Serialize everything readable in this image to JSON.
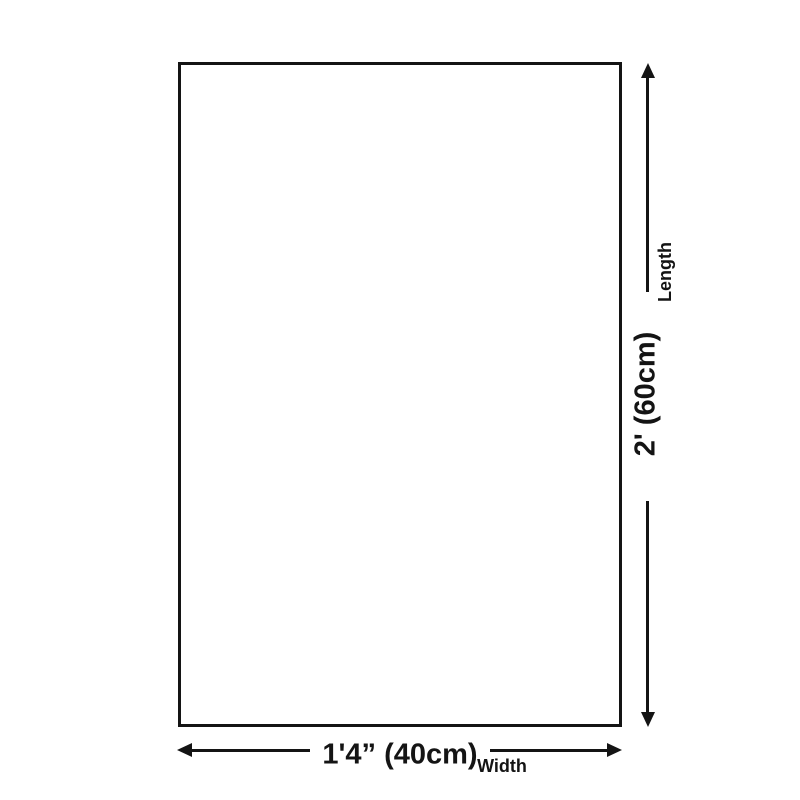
{
  "page": {
    "background_color": "#ffffff",
    "ink_color": "#141414"
  },
  "diagram": {
    "shape": "rectangle",
    "vertical_dimension": {
      "value": "2' (60cm)",
      "label": "Length"
    },
    "horizontal_dimension": {
      "value": "1'4” (40cm)",
      "label": "Width"
    }
  }
}
